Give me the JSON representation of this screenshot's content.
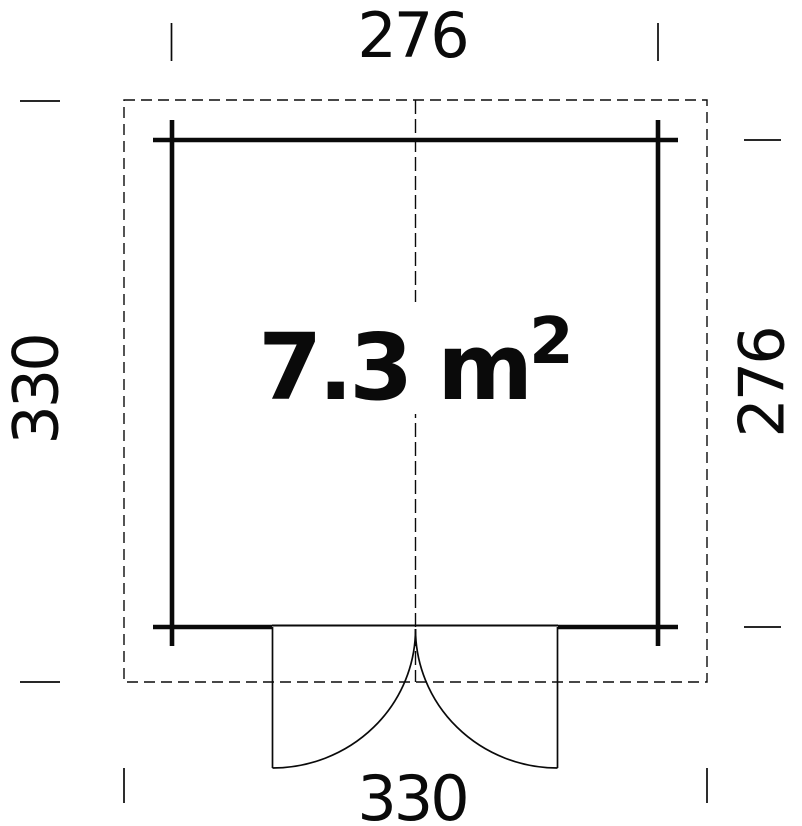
{
  "diagram": {
    "type": "shed-floor-plan",
    "area": {
      "value": "7.3 m",
      "exponent": "2",
      "display": "7.3 m²"
    },
    "dimensions": {
      "top": {
        "label": "276",
        "orientation": "horizontal"
      },
      "right": {
        "label": "276",
        "orientation": "vertical"
      },
      "left": {
        "label": "330",
        "orientation": "vertical"
      },
      "bottom": {
        "label": "330",
        "orientation": "horizontal"
      }
    },
    "colors": {
      "line": "#0a0a0a",
      "background": "#ffffff"
    }
  }
}
